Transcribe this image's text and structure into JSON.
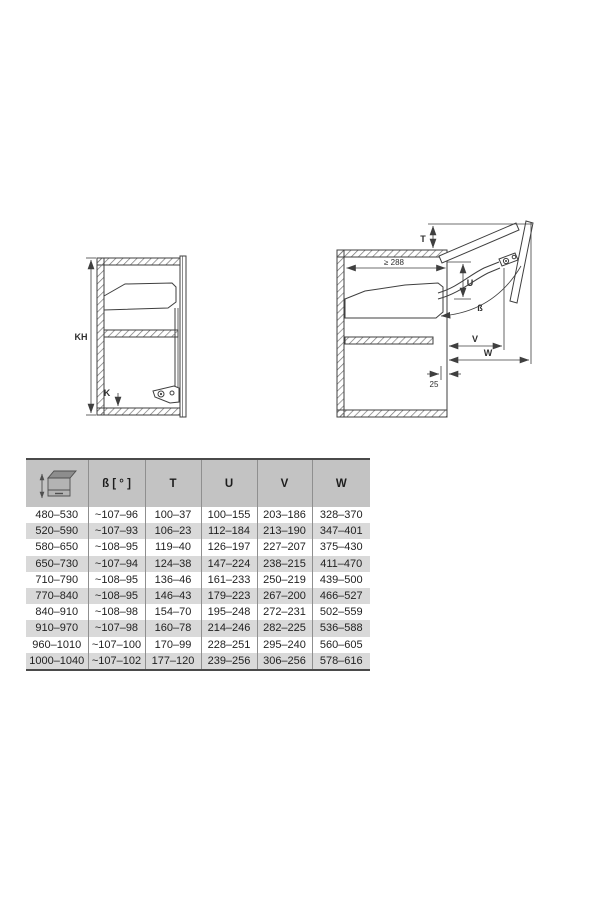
{
  "page": {
    "background": "#ffffff"
  },
  "diagram_left": {
    "description": "closed-cabinet-side-view",
    "labels": {
      "kh": "KH",
      "k": "K"
    }
  },
  "diagram_right": {
    "description": "open-cabinet-side-view",
    "labels": {
      "t": "T",
      "u": "U",
      "beta": "ß",
      "v": "V",
      "w": "W",
      "min_width": "≥ 288",
      "inset": "25"
    }
  },
  "table": {
    "header_icon": "cabinet-height-icon",
    "columns": [
      "",
      "ß [ ° ]",
      "T",
      "U",
      "V",
      "W"
    ],
    "rows": [
      [
        "480–530",
        "~107–96",
        "100–37",
        "100–155",
        "203–186",
        "328–370"
      ],
      [
        "520–590",
        "~107–93",
        "106–23",
        "112–184",
        "213–190",
        "347–401"
      ],
      [
        "580–650",
        "~108–95",
        "119–40",
        "126–197",
        "227–207",
        "375–430"
      ],
      [
        "650–730",
        "~107–94",
        "124–38",
        "147–224",
        "238–215",
        "411–470"
      ],
      [
        "710–790",
        "~108–95",
        "136–46",
        "161–233",
        "250–219",
        "439–500"
      ],
      [
        "770–840",
        "~108–95",
        "146–43",
        "179–223",
        "267–200",
        "466–527"
      ],
      [
        "840–910",
        "~108–98",
        "154–70",
        "195–248",
        "272–231",
        "502–559"
      ],
      [
        "910–970",
        "~107–98",
        "160–78",
        "214–246",
        "282–225",
        "536–588"
      ],
      [
        "960–1010",
        "~107–100",
        "170–99",
        "228–251",
        "295–240",
        "560–605"
      ],
      [
        "1000–1040",
        "~107–102",
        "177–120",
        "239–256",
        "306–256",
        "578–616"
      ]
    ],
    "colors": {
      "header_bg": "#c3c3c3",
      "row_bg": "#ffffff",
      "row_alt_bg": "#d9d9d9",
      "border": "#4a4a4a",
      "divider": "#8f8f8f",
      "text": "#222222",
      "line": "#3f3f3f"
    }
  }
}
